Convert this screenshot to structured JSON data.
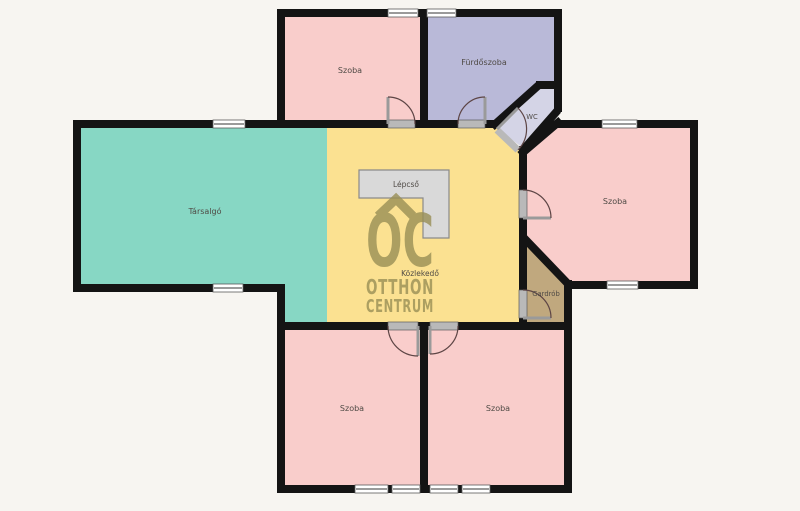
{
  "colors": {
    "background": "#f7f5f1",
    "wall": "#141414",
    "room_pink": "#f9cdcb",
    "bathroom": "#b9b9d8",
    "wc": "#d4d4e6",
    "lounge": "#87d7c4",
    "hallway": "#fbe191",
    "wardrobe": "#c0a87e",
    "stairs_fill": "#d9d9d9",
    "stairs_stroke": "#8a8a8a",
    "door_arc": "#5d4545",
    "door_leaf": "#9a9a9a",
    "sill": "#b9b9b9",
    "window_fill": "#ffffff",
    "window_edge": "#5a5a5a",
    "window_line": "#9a9a9a",
    "label": "#4f4a45",
    "logo": "#998f56"
  },
  "rooms": {
    "top_szoba": {
      "label": "Szoba"
    },
    "furdoszoba": {
      "label": "Fürdőszoba"
    },
    "wc": {
      "label": "WC"
    },
    "tarsalgo": {
      "label": "Társalgó"
    },
    "kozlekedo": {
      "label": "Közlekedő"
    },
    "lepcso": {
      "label": "Lépcső"
    },
    "right_szoba": {
      "label": "Szoba"
    },
    "gardrob": {
      "label": "Gardrób"
    },
    "bottom_left_szoba": {
      "label": "Szoba"
    },
    "bottom_right_szoba": {
      "label": "Szoba"
    }
  },
  "watermark": {
    "monogram": "OC",
    "line1": "OTTHON",
    "line2": "CENTRUM"
  }
}
